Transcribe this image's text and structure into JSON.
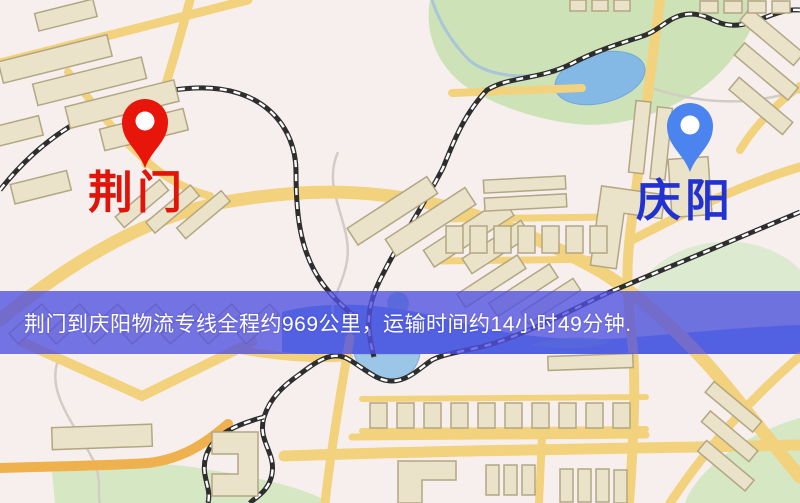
{
  "markers": {
    "origin": {
      "label": "荆门"
    },
    "destination": {
      "label": "庆阳"
    }
  },
  "banner": {
    "text": "荆门到庆阳物流专线全程约969公里，运输时间约14小时49分钟."
  },
  "route": {
    "distance_km": "969",
    "duration_hours": "14",
    "duration_minutes": "49"
  },
  "colors": {
    "origin-pin": "#e8150b",
    "origin-label": "#e01408",
    "destination-pin": "#4b84ee",
    "destination-label": "#2232d2",
    "banner-bg": "rgba(80,80,226,0.78)",
    "banner-text": "#ffffff"
  }
}
